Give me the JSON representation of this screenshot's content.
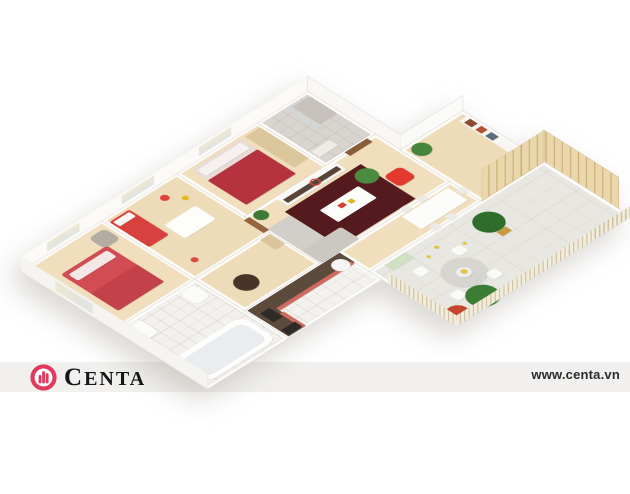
{
  "page": {
    "width": 630,
    "height": 494,
    "background": "#ffffff",
    "description": "3D isometric apartment floor plan render"
  },
  "watermark": {
    "brand": "CENTA",
    "url": "www.centa.vn",
    "band_color": "#f1f0ee",
    "logo_color": "#e23a5c",
    "brand_text_color": "#161616",
    "url_color": "#2b2b2b",
    "logo_icon": "building-in-circle-icon"
  },
  "palette": {
    "wood_floor": "#f0debc",
    "white_wall": "#fbfaf7",
    "accent_red": "#d24d53",
    "dark_rug": "#541a1e",
    "terrace_floor": "#e9e7e2",
    "plant_green": "#3e7a35",
    "fence_wood": "#f2ecdc",
    "screen_wood": "#ead7ab"
  },
  "scene": {
    "rooms": [
      {
        "name": "master-bedroom-floor",
        "x": 0,
        "y": 0,
        "w": 130,
        "h": 150,
        "bg": "#f0debc",
        "cls": "room"
      },
      {
        "name": "kids-room-floor",
        "x": 130,
        "y": 0,
        "w": 120,
        "h": 150,
        "bg": "#eedbb7",
        "cls": "room"
      },
      {
        "name": "bedroom2-floor",
        "x": 250,
        "y": 0,
        "w": 130,
        "h": 150,
        "bg": "#f0debc",
        "cls": "room"
      },
      {
        "name": "shower-bathroom-floor",
        "x": 380,
        "y": 0,
        "w": 80,
        "h": 110,
        "bg": "#d8d4cf",
        "cls": "room tile"
      },
      {
        "name": "bathroom-floor",
        "x": 0,
        "y": 150,
        "w": 130,
        "h": 150,
        "bg": "#f3f1ee",
        "cls": "room tile"
      },
      {
        "name": "hallway-floor",
        "x": 130,
        "y": 150,
        "w": 120,
        "h": 80,
        "bg": "#eedbb7",
        "cls": "room"
      },
      {
        "name": "kitchen-floor",
        "x": 130,
        "y": 230,
        "w": 150,
        "h": 70,
        "bg": "#f4f2ef",
        "cls": "room tile"
      },
      {
        "name": "living-room-floor",
        "x": 250,
        "y": 110,
        "w": 210,
        "h": 120,
        "bg": "#f0debc",
        "cls": "room"
      },
      {
        "name": "dining-floor",
        "x": 280,
        "y": 230,
        "w": 180,
        "h": 50,
        "bg": "#f0debc",
        "cls": "room"
      },
      {
        "name": "reading-corner-floor",
        "x": 460,
        "y": 150,
        "w": 100,
        "h": 130,
        "bg": "#eedbb7",
        "cls": "room"
      },
      {
        "name": "terrace-floor",
        "x": 280,
        "y": 280,
        "w": 280,
        "h": 140,
        "bg": "#e9e7e2",
        "cls": "room terrace"
      }
    ],
    "furniture": [
      {
        "name": "master-bed",
        "x": 28,
        "y": 36,
        "w": 74,
        "h": 92,
        "bg": "#d24d53",
        "br": "4px"
      },
      {
        "name": "master-bed-pillows",
        "x": 34,
        "y": 42,
        "w": 62,
        "h": 16,
        "bg": "#f3e8e6",
        "br": "3px"
      },
      {
        "name": "master-bed-blanket",
        "x": 28,
        "y": 84,
        "w": 74,
        "h": 44,
        "bg": "#c2414b",
        "br": "2px"
      },
      {
        "name": "master-armchair",
        "x": 96,
        "y": 12,
        "w": 26,
        "h": 26,
        "bg": "#b3aca4",
        "br": "7px"
      },
      {
        "name": "kids-bed",
        "x": 134,
        "y": 8,
        "w": 32,
        "h": 64,
        "bg": "#d8423e",
        "br": "3px"
      },
      {
        "name": "kids-bed-pillow",
        "x": 137,
        "y": 11,
        "w": 26,
        "h": 11,
        "bg": "#faf6f3",
        "br": "2px"
      },
      {
        "name": "kids-play-table",
        "x": 174,
        "y": 56,
        "w": 50,
        "h": 34,
        "bg": "#fdfdfc",
        "br": "3px"
      },
      {
        "name": "kids-toy-red",
        "x": 204,
        "y": 16,
        "w": 11,
        "h": 11,
        "bg": "#e04438",
        "cls": "furn round"
      },
      {
        "name": "kids-toy-yellow",
        "x": 222,
        "y": 34,
        "w": 8,
        "h": 8,
        "bg": "#e5b91e",
        "cls": "furn round"
      },
      {
        "name": "kids-toy-red-2",
        "x": 150,
        "y": 120,
        "w": 9,
        "h": 9,
        "bg": "#d84a3a",
        "cls": "furn round"
      },
      {
        "name": "bedroom2-bed",
        "x": 266,
        "y": 8,
        "w": 80,
        "h": 88,
        "bg": "#e9dcd6",
        "br": "3px"
      },
      {
        "name": "bedroom2-pillows",
        "x": 271,
        "y": 12,
        "w": 70,
        "h": 15,
        "bg": "#f6f1ee",
        "br": "2px"
      },
      {
        "name": "bedroom2-blanket",
        "x": 266,
        "y": 34,
        "w": 80,
        "h": 62,
        "bg": "#b5333e",
        "br": "2px"
      },
      {
        "name": "bedroom2-wardrobe",
        "x": 352,
        "y": 8,
        "w": 24,
        "h": 78,
        "bg": "#dcc69c"
      },
      {
        "name": "shower-tray",
        "x": 428,
        "y": 8,
        "w": 28,
        "h": 44,
        "bg": "#c6c1bb",
        "br": "3px"
      },
      {
        "name": "shower-glass",
        "x": 422,
        "y": 6,
        "w": 3,
        "h": 50,
        "bg": "#cfd9dd"
      },
      {
        "name": "bath-cabinet",
        "x": 386,
        "y": 80,
        "w": 30,
        "h": 14,
        "bg": "#efece8"
      },
      {
        "name": "bathtub",
        "x": 8,
        "y": 234,
        "w": 112,
        "h": 58,
        "bg": "#fdfdfc",
        "br": "14px"
      },
      {
        "name": "bathtub-inner",
        "x": 16,
        "y": 242,
        "w": 96,
        "h": 42,
        "bg": "#e9edef",
        "br": "10px"
      },
      {
        "name": "bath-sink",
        "x": 8,
        "y": 158,
        "w": 26,
        "h": 30,
        "bg": "#fbfbfa",
        "br": "4px"
      },
      {
        "name": "toilet",
        "x": 98,
        "y": 156,
        "w": 24,
        "h": 28,
        "bg": "#fbfbfa",
        "br": "8px"
      },
      {
        "name": "hall-round-table",
        "x": 152,
        "y": 180,
        "w": 30,
        "h": 30,
        "bg": "#4a3327",
        "cls": "furn round"
      },
      {
        "name": "hall-door",
        "x": 244,
        "y": 114,
        "w": 9,
        "h": 32,
        "bg": "#96653d"
      },
      {
        "name": "hall-console",
        "x": 232,
        "y": 152,
        "w": 16,
        "h": 24,
        "bg": "#d9c49c"
      },
      {
        "name": "entry-door",
        "x": 412,
        "y": 108,
        "w": 36,
        "h": 9,
        "bg": "#8a5c37"
      },
      {
        "name": "kitchen-counter-north",
        "x": 132,
        "y": 232,
        "w": 148,
        "h": 24,
        "bg": "#5c4a3c"
      },
      {
        "name": "kitchen-counter-west",
        "x": 132,
        "y": 232,
        "w": 26,
        "h": 66,
        "bg": "#5c4a3c"
      },
      {
        "name": "kitchen-front-north",
        "x": 158,
        "y": 252,
        "w": 120,
        "h": 6,
        "bg": "#cf6a5e"
      },
      {
        "name": "kitchen-front-west",
        "x": 154,
        "y": 262,
        "w": 6,
        "h": 36,
        "bg": "#cf6a5e"
      },
      {
        "name": "kitchen-sink",
        "x": 138,
        "y": 246,
        "w": 15,
        "h": 22,
        "bg": "#2e2a27",
        "br": "2px"
      },
      {
        "name": "kitchen-oven",
        "x": 134,
        "y": 284,
        "w": 22,
        "h": 12,
        "bg": "#2c2926"
      },
      {
        "name": "kitchen-fridge",
        "x": 254,
        "y": 238,
        "w": 22,
        "h": 22,
        "bg": "#f6f5f3",
        "cls": "furn round"
      },
      {
        "name": "kitchen-green-mat",
        "x": 300,
        "y": 284,
        "w": 34,
        "h": 14,
        "bg": "#cfe0c3"
      },
      {
        "name": "living-rug",
        "x": 288,
        "y": 136,
        "w": 122,
        "h": 88,
        "bg": "#541a1e"
      },
      {
        "name": "sofa-west",
        "x": 252,
        "y": 144,
        "w": 36,
        "h": 86,
        "bg": "#d2cfca",
        "br": "4px"
      },
      {
        "name": "sofa-corner",
        "x": 252,
        "y": 200,
        "w": 62,
        "h": 30,
        "bg": "#cbc8c2",
        "br": "4px"
      },
      {
        "name": "coffee-table",
        "x": 318,
        "y": 162,
        "w": 62,
        "h": 30,
        "bg": "#fdfdfc",
        "br": "2px"
      },
      {
        "name": "coffee-table-decor-red",
        "x": 338,
        "y": 170,
        "w": 9,
        "h": 7,
        "bg": "#d43f35"
      },
      {
        "name": "coffee-table-decor-yellow",
        "x": 352,
        "y": 172,
        "w": 7,
        "h": 7,
        "bg": "#e0b31f"
      },
      {
        "name": "red-pouf",
        "x": 412,
        "y": 170,
        "w": 27,
        "h": 27,
        "bg": "#e23a2e",
        "br": "7px"
      },
      {
        "name": "tv-sideboard",
        "x": 298,
        "y": 114,
        "w": 94,
        "h": 17,
        "bg": "#f8f8f6"
      },
      {
        "name": "tv-sideboard-shelf",
        "x": 302,
        "y": 119,
        "w": 86,
        "h": 8,
        "bg": "#574538"
      },
      {
        "name": "wall-clock",
        "x": 344,
        "y": 116,
        "w": 13,
        "h": 13,
        "cls": "el ring round"
      },
      {
        "name": "plant-living-corner",
        "x": 256,
        "y": 112,
        "w": 18,
        "h": 18,
        "bg": "#3e7a35",
        "cls": "furn round"
      },
      {
        "name": "plant-tv",
        "x": 386,
        "y": 142,
        "w": 28,
        "h": 28,
        "bg": "#4c8a40",
        "cls": "furn round"
      },
      {
        "name": "dining-table",
        "x": 376,
        "y": 236,
        "w": 74,
        "h": 32,
        "bg": "#fcfcfb",
        "br": "2px"
      },
      {
        "name": "dining-chair-1",
        "x": 384,
        "y": 224,
        "w": 11,
        "h": 11,
        "bg": "#eceae6",
        "br": "2px"
      },
      {
        "name": "dining-chair-2",
        "x": 410,
        "y": 224,
        "w": 11,
        "h": 11,
        "bg": "#eceae6",
        "br": "2px"
      },
      {
        "name": "dining-chair-3",
        "x": 384,
        "y": 270,
        "w": 11,
        "h": 11,
        "bg": "#eceae6",
        "br": "2px"
      },
      {
        "name": "dining-chair-4",
        "x": 410,
        "y": 270,
        "w": 11,
        "h": 11,
        "bg": "#eceae6",
        "br": "2px"
      },
      {
        "name": "dining-chair-5",
        "x": 452,
        "y": 246,
        "w": 11,
        "h": 11,
        "bg": "#eceae6",
        "br": "2px"
      },
      {
        "name": "plant-dining",
        "x": 466,
        "y": 154,
        "w": 24,
        "h": 24,
        "bg": "#47843c",
        "cls": "furn round"
      },
      {
        "name": "bookshelf",
        "x": 544,
        "y": 160,
        "w": 14,
        "h": 86,
        "bg": "#f7f6f3"
      },
      {
        "name": "books-1",
        "x": 546,
        "y": 166,
        "w": 10,
        "h": 12,
        "bg": "#8a4b2f"
      },
      {
        "name": "books-2",
        "x": 546,
        "y": 184,
        "w": 10,
        "h": 10,
        "bg": "#b3502e"
      },
      {
        "name": "books-3",
        "x": 546,
        "y": 200,
        "w": 10,
        "h": 12,
        "bg": "#5a6b7a"
      },
      {
        "name": "sideboard",
        "x": 492,
        "y": 252,
        "w": 56,
        "h": 20,
        "bg": "#f7f6f3"
      },
      {
        "name": "sideboard-decor",
        "x": 500,
        "y": 256,
        "w": 10,
        "h": 10,
        "bg": "#cbb089"
      },
      {
        "name": "terrace-table",
        "x": 328,
        "y": 330,
        "w": 54,
        "h": 54,
        "bg": "#d7d5d0",
        "cls": "furn round"
      },
      {
        "name": "terrace-table-top",
        "x": 346,
        "y": 348,
        "w": 18,
        "h": 18,
        "bg": "#efeeea",
        "cls": "furn round"
      },
      {
        "name": "terrace-table-decor",
        "x": 352,
        "y": 352,
        "w": 8,
        "h": 8,
        "bg": "#e3c63c",
        "cls": "furn round"
      },
      {
        "name": "terrace-chair-1",
        "x": 314,
        "y": 314,
        "w": 15,
        "h": 15,
        "bg": "#fafaf7",
        "br": "4px"
      },
      {
        "name": "terrace-chair-2",
        "x": 372,
        "y": 318,
        "w": 15,
        "h": 15,
        "bg": "#fafaf7",
        "br": "4px"
      },
      {
        "name": "terrace-chair-3",
        "x": 314,
        "y": 374,
        "w": 15,
        "h": 15,
        "bg": "#fafaf7",
        "br": "4px"
      },
      {
        "name": "terrace-chair-4",
        "x": 370,
        "y": 376,
        "w": 15,
        "h": 15,
        "bg": "#fafaf7",
        "br": "4px"
      },
      {
        "name": "terrace-tree-1",
        "x": 420,
        "y": 294,
        "w": 38,
        "h": 38,
        "bg": "#2f6d2b",
        "cls": "furn round"
      },
      {
        "name": "terrace-tree-1-pot",
        "x": 432,
        "y": 332,
        "w": 15,
        "h": 10,
        "bg": "#c89a3e"
      },
      {
        "name": "terrace-tree-2",
        "x": 320,
        "y": 382,
        "w": 40,
        "h": 40,
        "bg": "#3a7d33",
        "cls": "furn round"
      },
      {
        "name": "terrace-flower-pot",
        "x": 284,
        "y": 390,
        "w": 28,
        "h": 28,
        "bg": "#c2452c",
        "cls": "furn round"
      },
      {
        "name": "terrace-leaf-1",
        "x": 362,
        "y": 300,
        "w": 6,
        "h": 6,
        "bg": "#e2c63e",
        "cls": "furn round"
      },
      {
        "name": "terrace-leaf-2",
        "x": 390,
        "y": 318,
        "w": 5,
        "h": 5,
        "bg": "#e2c63e",
        "cls": "furn round"
      },
      {
        "name": "terrace-leaf-3",
        "x": 344,
        "y": 306,
        "w": 5,
        "h": 5,
        "bg": "#e2c63e",
        "cls": "furn round"
      }
    ],
    "walls": [
      {
        "name": "exterior-wall-north",
        "x": 0,
        "y": -22,
        "w": 460,
        "h": 22,
        "bg": "#fbfaf7",
        "stand": "bottom",
        "cls": "wall win-n"
      },
      {
        "name": "exterior-wall-west",
        "x": -22,
        "y": 0,
        "w": 22,
        "h": 300,
        "bg": "#f6f4f1",
        "stand": "right",
        "cls": "wall win-w"
      },
      {
        "name": "exterior-wall-notch-east",
        "x": 460,
        "y": 0,
        "w": 22,
        "h": 150,
        "bg": "#f8f7f5",
        "stand": "left",
        "cls": "wall"
      },
      {
        "name": "exterior-wall-notch-south",
        "x": 460,
        "y": 150,
        "w": 100,
        "h": 22,
        "bg": "#fafaf8",
        "stand": "top",
        "cls": "wall"
      },
      {
        "name": "terrace-fence-west",
        "x": 264,
        "y": 310,
        "w": 16,
        "h": 110,
        "stand": "right",
        "cls": "fence-v"
      },
      {
        "name": "terrace-fence-south",
        "x": 280,
        "y": 420,
        "w": 280,
        "h": 16,
        "stand": "top",
        "cls": "fence-h"
      },
      {
        "name": "terrace-screen-north",
        "x": 460,
        "y": 234,
        "w": 100,
        "h": 46,
        "stand": "bottom",
        "cls": "screen-h"
      },
      {
        "name": "terrace-screen-east",
        "x": 560,
        "y": 280,
        "w": 46,
        "h": 120,
        "stand": "left",
        "cls": "screen-v"
      }
    ]
  }
}
